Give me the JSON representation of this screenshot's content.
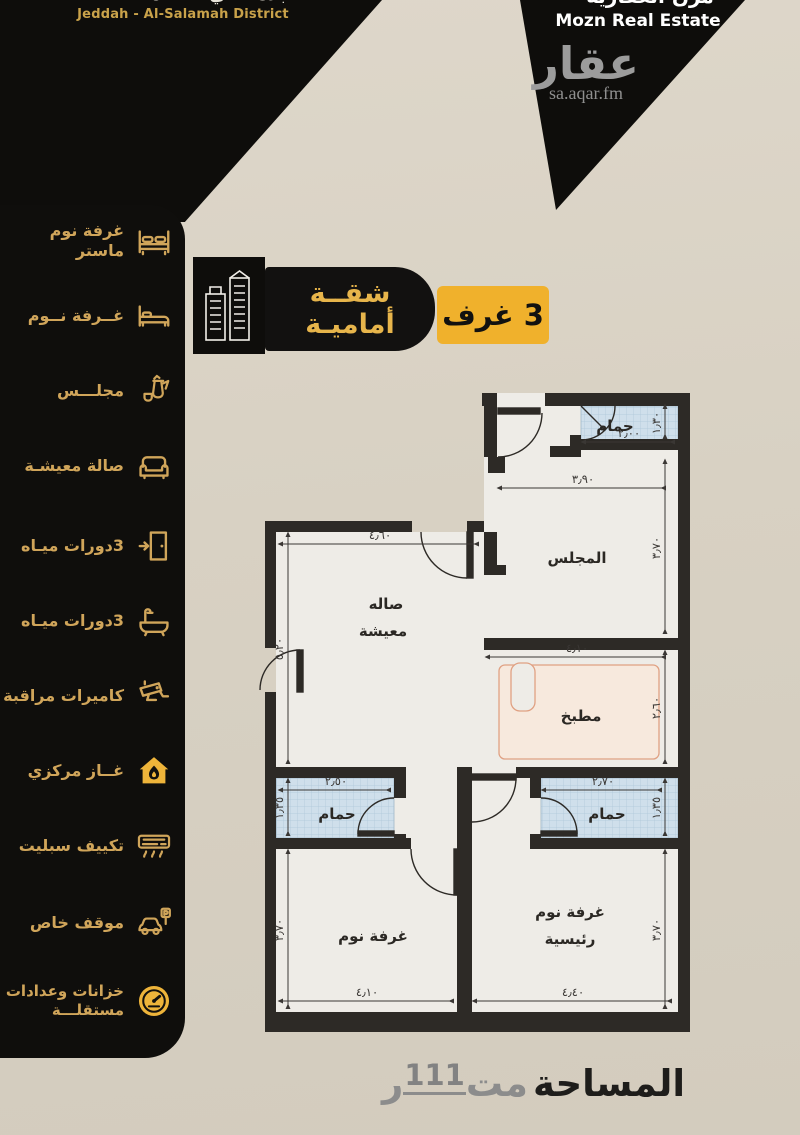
{
  "header": {
    "location_clipped_ar": "جدة - حي السلامة",
    "location_en": "Jeddah - Al-Salamah District",
    "brand_clipped_ar": "مزن العقارية",
    "brand_en": "Mozn Real Estate",
    "watermark_logo": "عقار",
    "watermark_url": "sa.aqar.fm"
  },
  "badge": {
    "title_line1": "شقــة",
    "title_line2": "أماميـة",
    "rooms_count": "3 غرف"
  },
  "features": [
    {
      "label": "غرفة نوم ماستر",
      "icon": "master-bed-icon"
    },
    {
      "label": "غــرفة نــوم",
      "icon": "bed-icon"
    },
    {
      "label": "مجلـــس",
      "icon": "coffee-pot-icon"
    },
    {
      "label": "صالة معيشـة",
      "icon": "sofa-icon"
    },
    {
      "label": "مدخــــلين",
      "icon": "door-icon"
    },
    {
      "label": "3دورات ميـاه",
      "icon": "bathtub-icon"
    },
    {
      "label": "كاميرات مراقبة",
      "icon": "cctv-camera-icon"
    },
    {
      "label": "غــاز مركزي",
      "icon": "gas-house-icon"
    },
    {
      "label": "تكييف سبليت",
      "icon": "ac-unit-icon"
    },
    {
      "label": "موقف خاص",
      "icon": "parking-car-icon"
    },
    {
      "label": "خزانات وعدادات",
      "label2": "مستقلـــة",
      "icon": "meter-gauge-icon"
    }
  ],
  "plan": {
    "rooms": {
      "bath_top": "حمام",
      "majlis": "المجلس",
      "living_1": "صاله",
      "living_2": "معيشة",
      "kitchen": "مطبخ",
      "bath_left": "حمام",
      "bath_right": "حمام",
      "bedroom": "غرفة نوم",
      "master_1": "غرفة نوم",
      "master_2": "رئيسية"
    },
    "dims": {
      "bath_top_w": "٢٫٠٠",
      "bath_top_h": "١٫٣٠",
      "majlis_w": "٣٫٩٠",
      "majlis_h": "٣٫٧٠",
      "living_w": "٤٫٦٠",
      "living_h": "٥٫٢٠",
      "kitchen_w": "٤٫١٠",
      "kitchen_h": "٢٫٦٠",
      "bath_left_w": "٢٫٥٠",
      "bath_left_h": "١٫٣٥",
      "bath_right_w": "٢٫٧٠",
      "bath_right_h": "١٫٣٥",
      "bedroom_w": "٤٫١٠",
      "bedroom_h": "٣٫٧٠",
      "master_w": "٤٫٤٠",
      "master_h": "٣٫٧٠"
    }
  },
  "footer": {
    "area_label": "المساحة",
    "area_unit_start": "مت",
    "area_value": "111",
    "area_unit_end": "ر"
  },
  "colors": {
    "gold": "#d0a55a",
    "yellow": "#f0b12c",
    "black": "#0e0d0b",
    "tile": "#cfdfeb",
    "counter_stroke": "#e0a183",
    "wall": "#2d2a26"
  }
}
